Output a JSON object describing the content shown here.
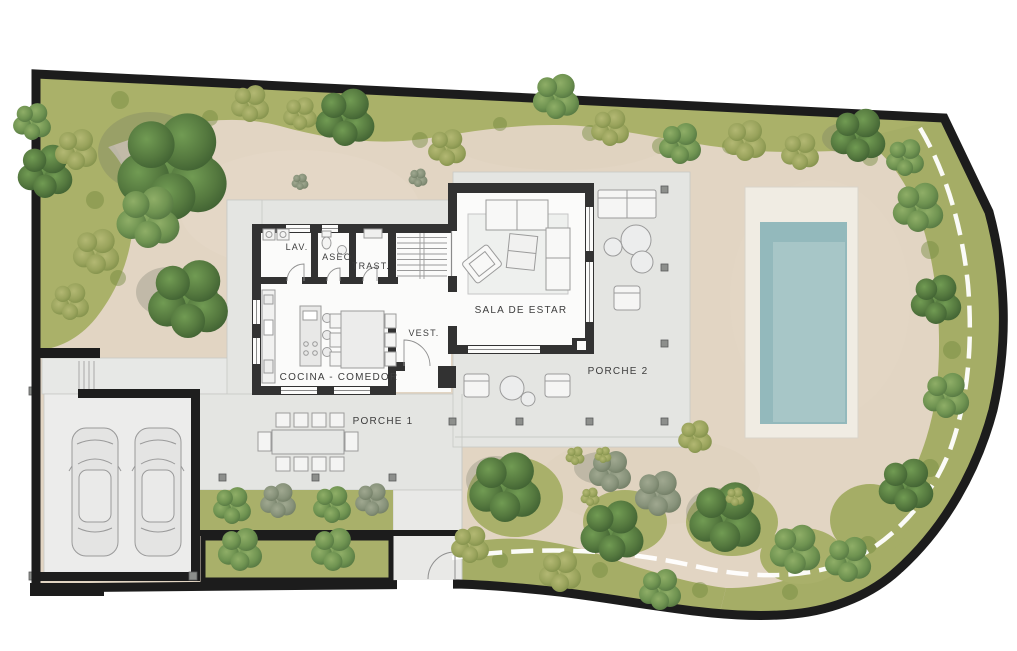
{
  "plan": {
    "kind": "villa ground-floor site plan",
    "rooms": [
      {
        "id": "lav",
        "label": "LAV."
      },
      {
        "id": "aseo",
        "label": "ASEO"
      },
      {
        "id": "trast",
        "label": "TRAST."
      },
      {
        "id": "vest",
        "label": "VEST."
      },
      {
        "id": "sala-de-estar",
        "label": "SALA DE ESTAR"
      },
      {
        "id": "cocina-comedor",
        "label": "COCINA - COMEDOR"
      },
      {
        "id": "porche-1",
        "label": "PORCHE 1"
      },
      {
        "id": "porche-2",
        "label": "PORCHE 2"
      }
    ],
    "colors": {
      "boundary_wall": "#1c1c1c",
      "sand_gravel": "#e2d5c3",
      "grass_band": "#a9b06a",
      "tree_green": "#55793f",
      "terrace_gray": "#e4e5e2",
      "house_wall": "#323232",
      "pool_water_outer": "#93b9bc",
      "pool_water_inner": "#a7c6c7",
      "pool_deck": "#f0ece3",
      "white_path": "#ffffff",
      "car_body": "#e4e4e3"
    }
  }
}
